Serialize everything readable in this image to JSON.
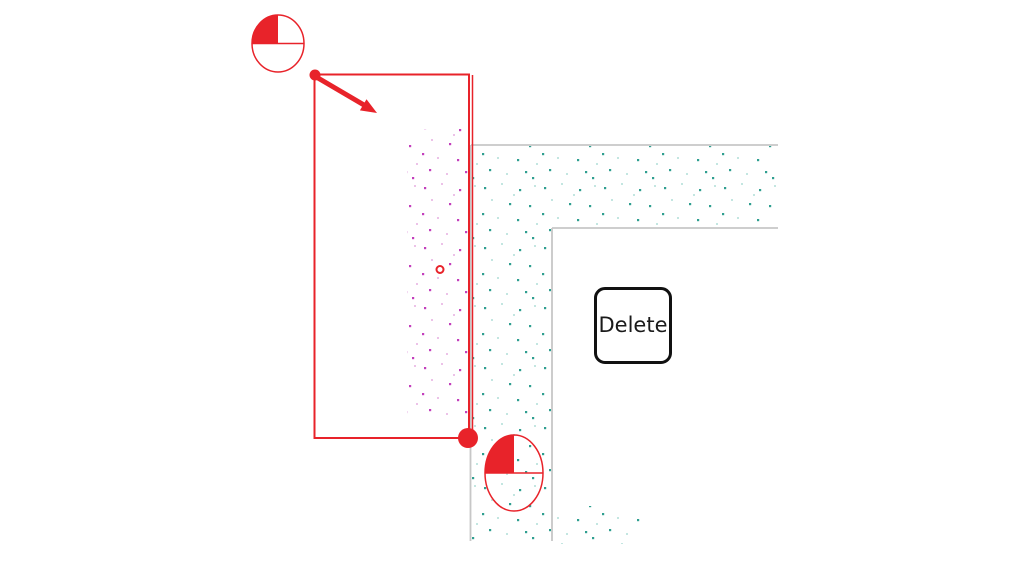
{
  "canvas": {
    "width": 1024,
    "height": 576,
    "background": "#ffffff"
  },
  "colors": {
    "red": "#e8232a",
    "magenta_dot": "#c33fbc",
    "magenta_dot_light": "#e09ad8",
    "teal_dot": "#2f9f90",
    "teal_dot_light": "#9bd6cd",
    "wall_outline": "#c7c7c7",
    "key_border": "#111111",
    "key_text": "#1a1a1a",
    "key_background": "#ffffff"
  },
  "delete_key": {
    "label": "Delete"
  },
  "icons": {
    "click_indicator_top": "quarter-filled-circle-with-diameter-line",
    "click_indicator_bottom": "quarter-filled-circle-with-diameter-line",
    "drag_arrow": "diagonal-arrow-down-right",
    "vertex_handle_start": "small-red-dot",
    "vertex_handle_end": "large-red-dot",
    "wall_midpoint_marker": "small-red-ring"
  }
}
